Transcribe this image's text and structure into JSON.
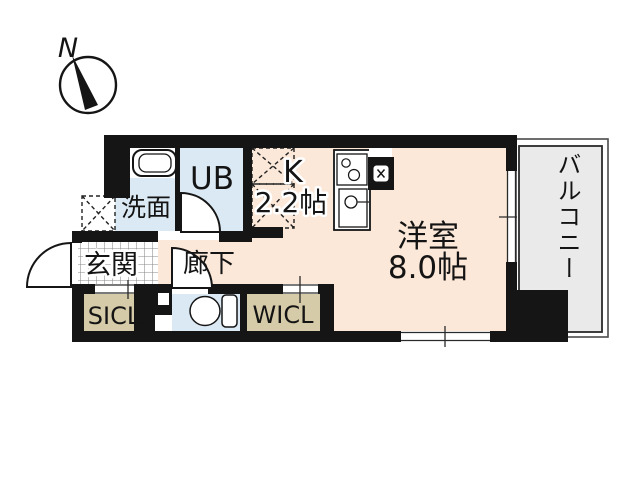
{
  "compass": {
    "north_label": "N"
  },
  "rooms": {
    "washroom": {
      "label": "洗面"
    },
    "unit_bath": {
      "label": "UB"
    },
    "kitchen": {
      "label": "K",
      "size": "2.2帖"
    },
    "western_room": {
      "label": "洋室",
      "size": "8.0帖"
    },
    "balcony": {
      "label": "バルコニー"
    },
    "entrance": {
      "label": "玄関"
    },
    "hallway": {
      "label": "廊下"
    },
    "shoe_closet": {
      "label": "SICL"
    },
    "walk_in_closet": {
      "label": "WICL"
    }
  },
  "colors": {
    "room_peach": "#fce8d8",
    "wet_area_blue": "#dbe9f4",
    "closet_tan": "#d6cba8",
    "balcony_gray": "#eaeaea",
    "wall_black": "#151515",
    "tile_line_gray": "#8a8a8a"
  }
}
